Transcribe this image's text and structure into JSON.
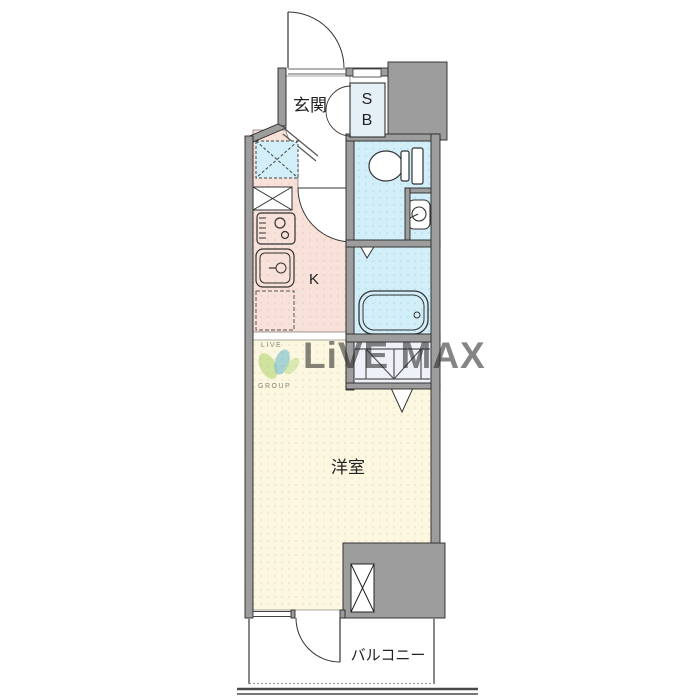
{
  "labels": {
    "entrance": "玄関",
    "shoe_box_line1": "S",
    "shoe_box_line2": "B",
    "kitchen": "K",
    "western_room": "洋室",
    "balcony": "バルコニー"
  },
  "watermark": {
    "brand": "LiVE MAX",
    "logo_top": "LIVE",
    "logo_bottom": "GROUP"
  },
  "colors": {
    "wall": "#9d9d9d",
    "kitchen": "#f7e1d8",
    "water": "#d2eef8",
    "room": "#fcf8e0",
    "storage": "#eef1f8",
    "white": "#ffffff",
    "line": "#333333",
    "watermark": "#7fb8d4",
    "logo_green": "#8dc63f",
    "logo_teal": "#2f9ec4"
  },
  "icons": {
    "toilet": "toilet-icon",
    "bathtub": "bathtub-icon",
    "stove": "gas-stove-icon",
    "sink": "kitchen-sink-icon",
    "washbasin": "washbasin-icon",
    "washing_machine": "washing-machine-space-icon",
    "refrigerator_space": "x-box-icon",
    "pipe_space": "x-box-icon",
    "door_swing": "door-arc-icon",
    "folding_door": "zigzag-hatch-icon",
    "door_triangle": "triangle-door-icon"
  }
}
